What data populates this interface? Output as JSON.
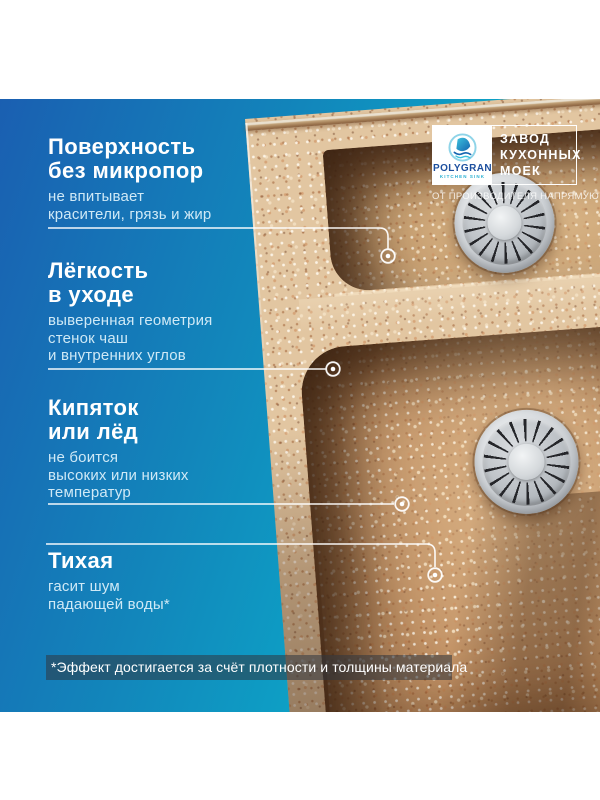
{
  "badge": {
    "brand": "POLYGRAN",
    "brand_sub": "KITCHEN SINK",
    "factory_lines": [
      "ЗАВОД",
      "КУХОННЫХ",
      "МОЕК"
    ],
    "tagline": "ОТ ПРОИЗВОДИТЕЛЯ НАПРЯМУЮ"
  },
  "features": [
    {
      "title_lines": [
        "Поверхность",
        "без микропор"
      ],
      "desc_lines": [
        "не впитывает",
        "красители, грязь и жир"
      ]
    },
    {
      "title_lines": [
        "Лёгкость",
        "в уходе"
      ],
      "desc_lines": [
        "выверенная геометрия",
        "стенок чаш",
        "и внутренних углов"
      ]
    },
    {
      "title_lines": [
        "Кипяток",
        "или лёд"
      ],
      "desc_lines": [
        "не боится",
        "высоких или низких",
        "температур"
      ]
    },
    {
      "title_lines": [
        "Тихая"
      ],
      "desc_lines": [
        "гасит шум",
        "падающей воды*"
      ]
    }
  ],
  "footnote": "*Эффект достигается за счёт плотности и толщины материала",
  "colors": {
    "gradient_dark_blue": "#1a5fb1",
    "gradient_cyan": "#0caac9",
    "granite_sand": "#e2c6a1",
    "feature_desc_text": "#cfe9f6",
    "brand_blue": "#1c4f9e",
    "brand_teal": "#28b0d2",
    "callout_white": "#ffffff"
  }
}
